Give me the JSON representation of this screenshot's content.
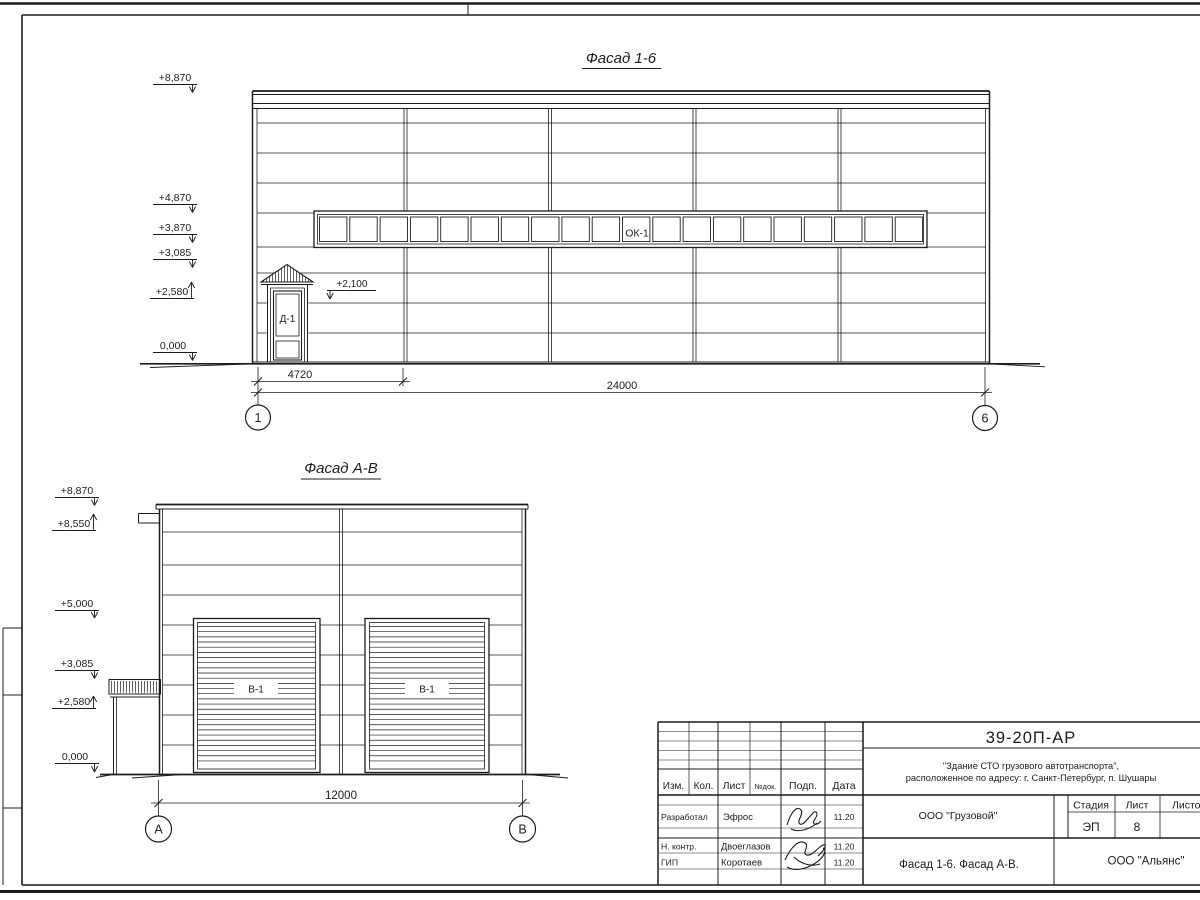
{
  "colors": {
    "ink": "#1c1c1c",
    "paper": "#ffffff"
  },
  "facade_1_6": {
    "title": "Фасад 1-6",
    "elev_top": "+8,870",
    "elev_band_top": "+4,870",
    "elev_band_bottom": "+3,870",
    "elev_3085": "+3,085",
    "elev_2580": "+2,580",
    "elev_zero": "0,000",
    "door_elev": "+2,100",
    "window_label": "ОК-1",
    "door_label": "Д-1",
    "dim_bay": "4720",
    "dim_total": "24000",
    "axis_start": "1",
    "axis_end": "6"
  },
  "facade_a_b": {
    "title": "Фасад А-В",
    "elev_top": "+8,870",
    "elev_8550": "+8,550",
    "elev_5000": "+5,000",
    "elev_3085": "+3,085",
    "elev_2580": "+2,580",
    "elev_zero": "0,000",
    "gate_label_left": "В-1",
    "gate_label_right": "В-1",
    "dim_total": "12000",
    "axis_start": "А",
    "axis_end": "В"
  },
  "title_block": {
    "doc_number": "39-20П-АР",
    "project_name_line1": "\"Здание СТО грузового автотранспорта\",",
    "project_name_line2": "расположенное по адресу: г. Санкт-Петербург, п. Шушары",
    "col_izm": "Изм.",
    "col_kol": "Кол.",
    "col_list": "Лист",
    "col_doc": "№док.",
    "col_sign": "Подп.",
    "col_date": "Дата",
    "rows": [
      {
        "role": "Разработал",
        "name": "Эфрос",
        "date": "11.20"
      },
      {
        "role": "Н. контр.",
        "name": "Двоеглазов",
        "date": "11.20"
      },
      {
        "role": "ГИП",
        "name": "Коротаев",
        "date": "11.20"
      }
    ],
    "client": "ООО \"Грузовой\"",
    "stage_label": "Стадия",
    "sheet_label": "Лист",
    "sheets_label": "Листов",
    "stage_value": "ЭП",
    "sheet_value": "8",
    "drawing_title": "Фасад 1-6. Фасад А-В.",
    "company": "ООО \"Альянс\""
  }
}
